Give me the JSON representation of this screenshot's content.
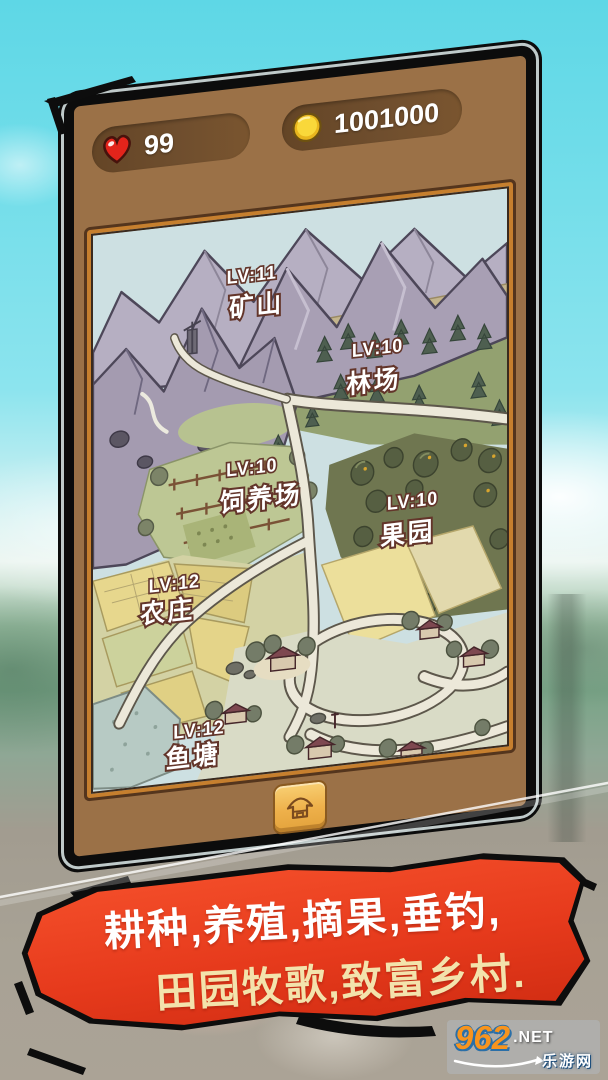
{
  "hud": {
    "health": "99",
    "coins": "1001000",
    "health_icon": "heart-icon",
    "coins_icon": "coin-icon"
  },
  "map": {
    "locations": [
      {
        "level": "LV:11",
        "name": "矿山"
      },
      {
        "level": "LV:10",
        "name": "林场"
      },
      {
        "level": "LV:10",
        "name": "饲养场"
      },
      {
        "level": "LV:10",
        "name": "果园"
      },
      {
        "level": "LV:12",
        "name": "农庄"
      },
      {
        "level": "LV:12",
        "name": "鱼塘"
      }
    ]
  },
  "bottom_bar": {
    "home_button_icon": "hut-icon"
  },
  "banner": {
    "line1": "耕种,养殖,摘果,垂钓,",
    "line2": "田园牧歌,致富乡村."
  },
  "watermark": {
    "site": "962",
    "domain": ".NET",
    "name": "乐游网"
  },
  "colors": {
    "sky": "#6edce9",
    "phone_brown": "#9b7147",
    "bezel_orange": "#c67f2e",
    "pill_brown": "#6f4e2e",
    "banner_red": "#e63a1c",
    "banner_text_cream": "#f3e3ac",
    "coin_gold": "#f2c12e",
    "heart_red": "#e3241b",
    "watermark_orange": "#f7941e"
  }
}
